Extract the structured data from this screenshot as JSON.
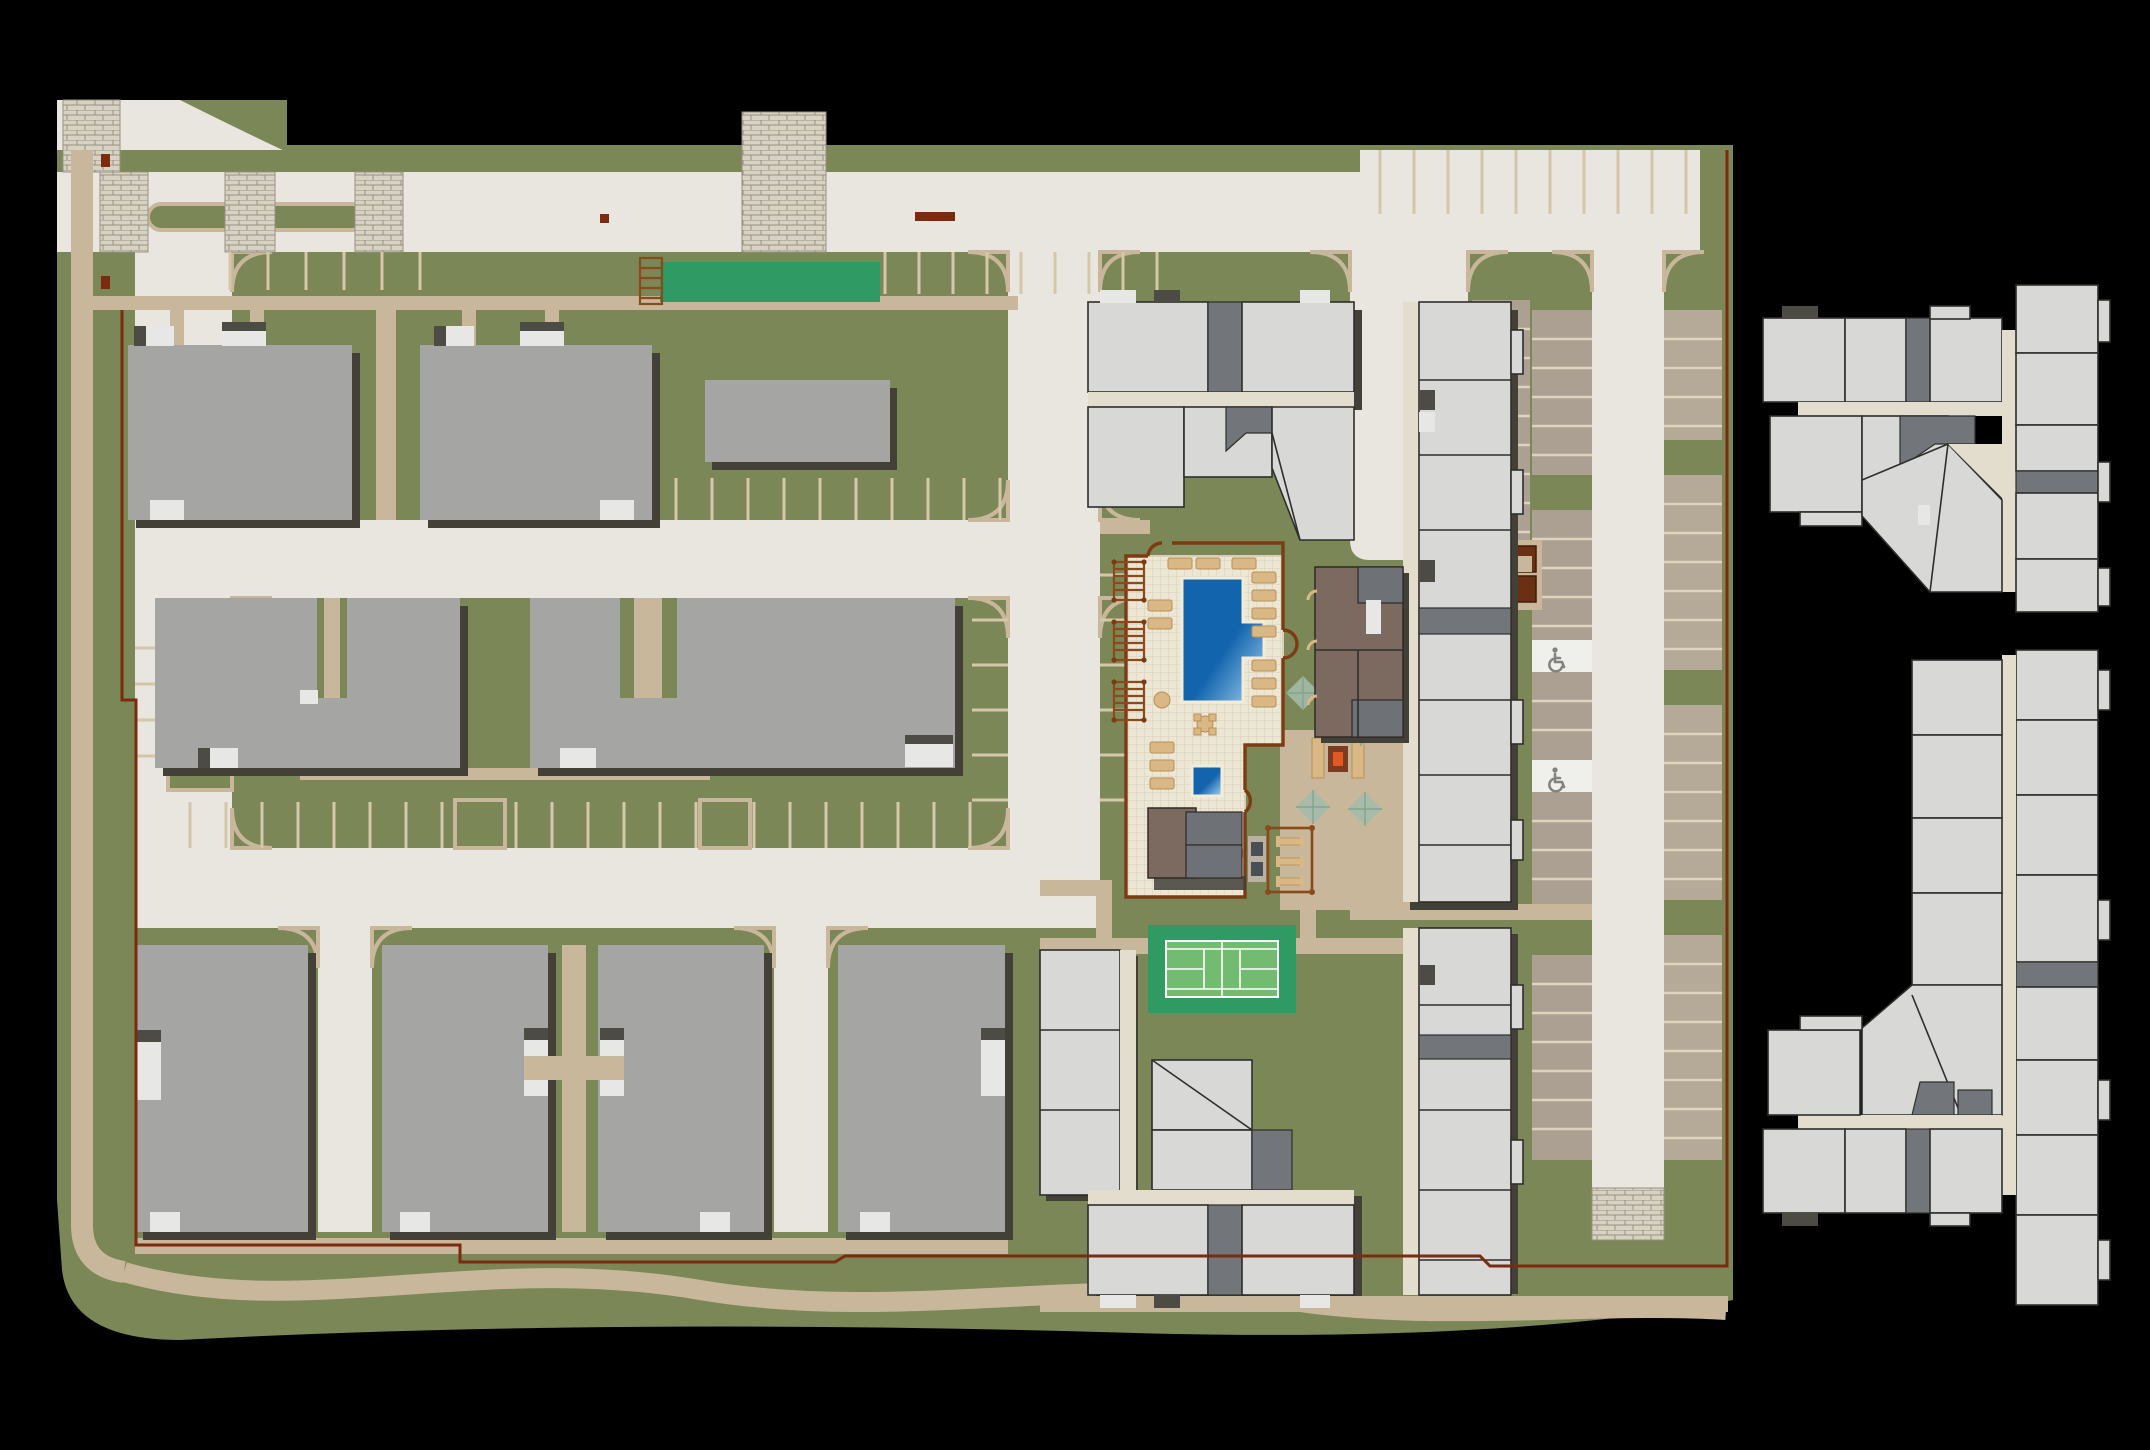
{
  "canvas": {
    "width": 2150,
    "height": 1450
  },
  "colors": {
    "background": "#000000",
    "grass": "#7b8756",
    "road": "#e8e6df",
    "sidewalk": "#c8b79a",
    "stall_line": "#d5c7aa",
    "stall_fill_a": "#aba092",
    "stall_fill_b": "#b5a997",
    "stall_divider": "#ddd3be",
    "accessible_stall": "#efefec",
    "accessible_icon": "#83837e",
    "building_gray": "#a5a5a4",
    "building_shadow": "#424037",
    "porch_light": "#e7e7e5",
    "porch_dark": "#4c4b44",
    "unit_light": "#d8d8d6",
    "unit_outline": "#2e2e2c",
    "stair_core": "#72757a",
    "corridor": "#e3ddce",
    "clubhouse_brown": "#7c6a61",
    "clubhouse_gray": "#6e7277",
    "pool_deep": "#1264ad",
    "pool_shallow": "#a8d4f2",
    "pool_coping": "#f2ecd9",
    "deck_tile": "#ece6d5",
    "deck_grout": "#d9cfb8",
    "pool_fence": "#7b3c14",
    "boundary_fence": "#7a2b10",
    "lounger": "#d9b886",
    "lounger_line": "#b98f56",
    "pergola": "#8a4a1c",
    "tennis_pad": "#2f9a64",
    "tennis_court": "#74bb72",
    "tennis_line": "#ffffff",
    "lawn_panel": "#2f9a64",
    "umbrella": "#a3bcab",
    "umbrella_line": "#86a391",
    "fire_pit": "#e25822",
    "fire_pit_ring": "#7c3b23",
    "picnic_fence": "#8a4a1c",
    "kiosk": "#6b3014",
    "brick_fill": "#d7d2c4",
    "brick_line": "#97917f",
    "grill_pad": "#b9b2a4",
    "grill": "#4a4e55"
  },
  "site": {
    "type": "apartment-community-site-plan",
    "gray_garden_buildings": 9,
    "wrap_building_clusters": 2,
    "floorplan_inset_clusters": 2,
    "amenities": [
      "swimming-pool",
      "spa",
      "pool-deck",
      "pool-fence",
      "pergolas",
      "clubhouse",
      "fire-pit-patio",
      "shade-umbrellas",
      "picnic-area",
      "bbq-grills",
      "pool-equipment-building",
      "tennis-court",
      "event-lawn-panel",
      "arbor",
      "mail-kiosk",
      "accessible-parking",
      "perimeter-walking-trail",
      "brick-crosswalks"
    ]
  }
}
